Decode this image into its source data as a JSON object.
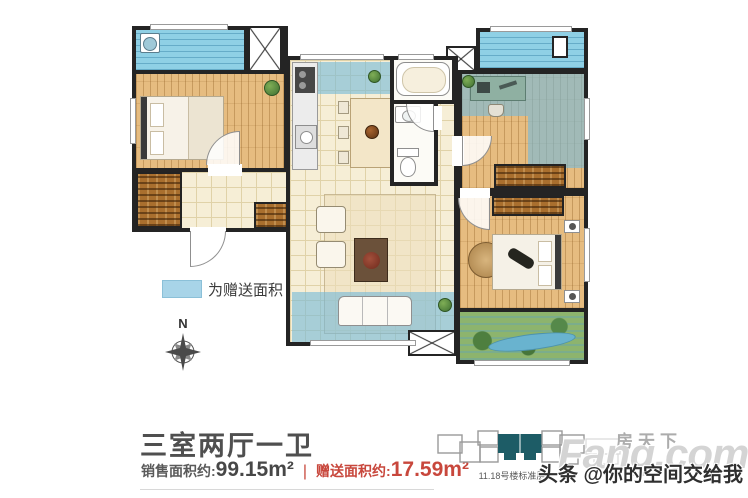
{
  "plan": {
    "legend": {
      "label": "为赠送面积",
      "swatch_color": "#a8d4e8"
    },
    "compass": {
      "north": "N"
    }
  },
  "info": {
    "title": "三室两厅一卫",
    "sale_label": "销售面积约:",
    "sale_value": "99.15m²",
    "separator": "|",
    "gift_label": "赠送面积约:",
    "gift_value": "17.59m²",
    "accent_color": "#c8473c"
  },
  "key_plan": {
    "caption": "11.18号楼标准层",
    "highlight_color": "#1d5c66"
  },
  "watermark": {
    "brand_cn": "房天下",
    "brand_en": "Fang.com",
    "credit": "头条 @你的空间交给我"
  }
}
